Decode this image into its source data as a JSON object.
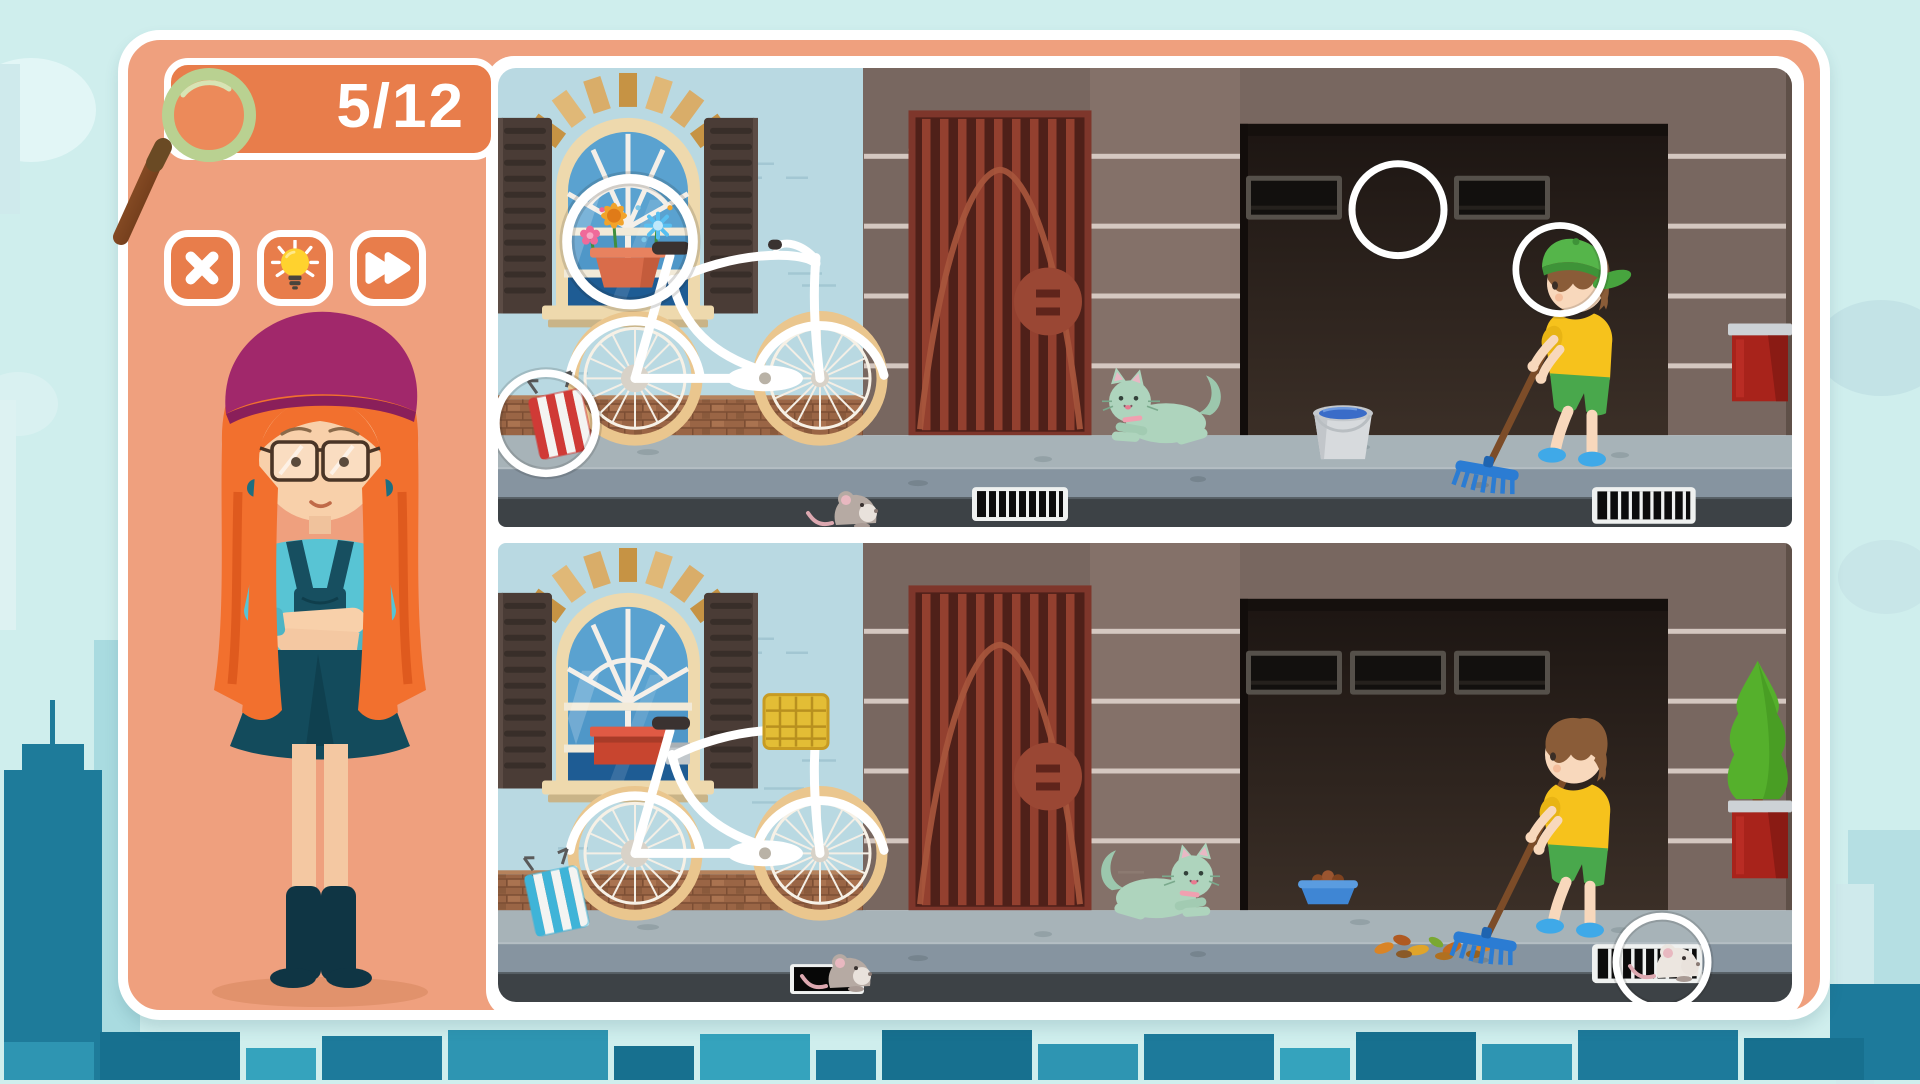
{
  "app": {
    "type": "spot-the-difference-game"
  },
  "hud": {
    "score": {
      "found": 5,
      "total": 12,
      "display": "5/12",
      "icon": "magnifier-icon"
    },
    "buttons": [
      {
        "id": "close",
        "label": "Close",
        "icon": "x-icon"
      },
      {
        "id": "hint",
        "label": "Hint",
        "icon": "lightbulb-icon"
      },
      {
        "id": "skip",
        "label": "Skip",
        "icon": "fast-forward-icon"
      }
    ]
  },
  "character": {
    "name": "guide-girl",
    "description": "Girl with long orange hair, magenta beret, round glasses, teal t-shirt, dark teal overall dress and boots, arms crossed"
  },
  "board": {
    "mode": "two nearly identical street scenes stacked vertically",
    "scene_objects": [
      "arched window with brown shutters and brick arch",
      "flower pot with orange, blue and pink flowers (top scene only)",
      "red window planter box (bottom scene only)",
      "white bicycle with tan wheels",
      "yellow bicycle basket (bottom scene only)",
      "folded striped deck chair (red stripes top, blue stripes bottom)",
      "dark red iron gate with round hinge",
      "brown building wall with white lines",
      "dark garage opening with small windows (2 windows top, 3 windows bottom)",
      "mint green running cat",
      "metal bucket of water (top scene only)",
      "blue pet food bowl (bottom scene only)",
      "boy raking with blue rake (green cap in top scene only)",
      "pile of autumn leaves (bottom scene only)",
      "street drains",
      "grey mouse on sidewalk",
      "white mouse at right drain (bottom scene only)",
      "red planter on right ledge",
      "green topiary tree (bottom scene only)"
    ],
    "differences_found": [
      {
        "n": 1,
        "scene": "top",
        "target": "flowers-in-window-pot"
      },
      {
        "n": 2,
        "scene": "top",
        "target": "red-striped-folded-chair"
      },
      {
        "n": 3,
        "scene": "top",
        "target": "missing-middle-garage-window"
      },
      {
        "n": 4,
        "scene": "top",
        "target": "boy-green-cap"
      },
      {
        "n": 5,
        "scene": "bottom",
        "target": "white-mouse-at-drain"
      }
    ]
  },
  "colors": {
    "sky": "#cfeeed",
    "panel_salmon": "#efa07e",
    "accent_orange": "#e87d4b",
    "white": "#ffffff",
    "skyline_dark_teal": "#1d7a9b",
    "skyline_light_teal": "#a9dbe0",
    "scene_wall_blue": "#b9d9e2",
    "scene_wall_brown": "#786760",
    "gate_maroon": "#8f4134",
    "garage_dark": "#241c17",
    "cat_mint": "#aed4bd",
    "boy_shirt_yellow": "#f6c21c",
    "boy_shorts_green": "#49a84c",
    "rake_blue": "#2d7fd6",
    "marker_ring": "#ffffff"
  }
}
